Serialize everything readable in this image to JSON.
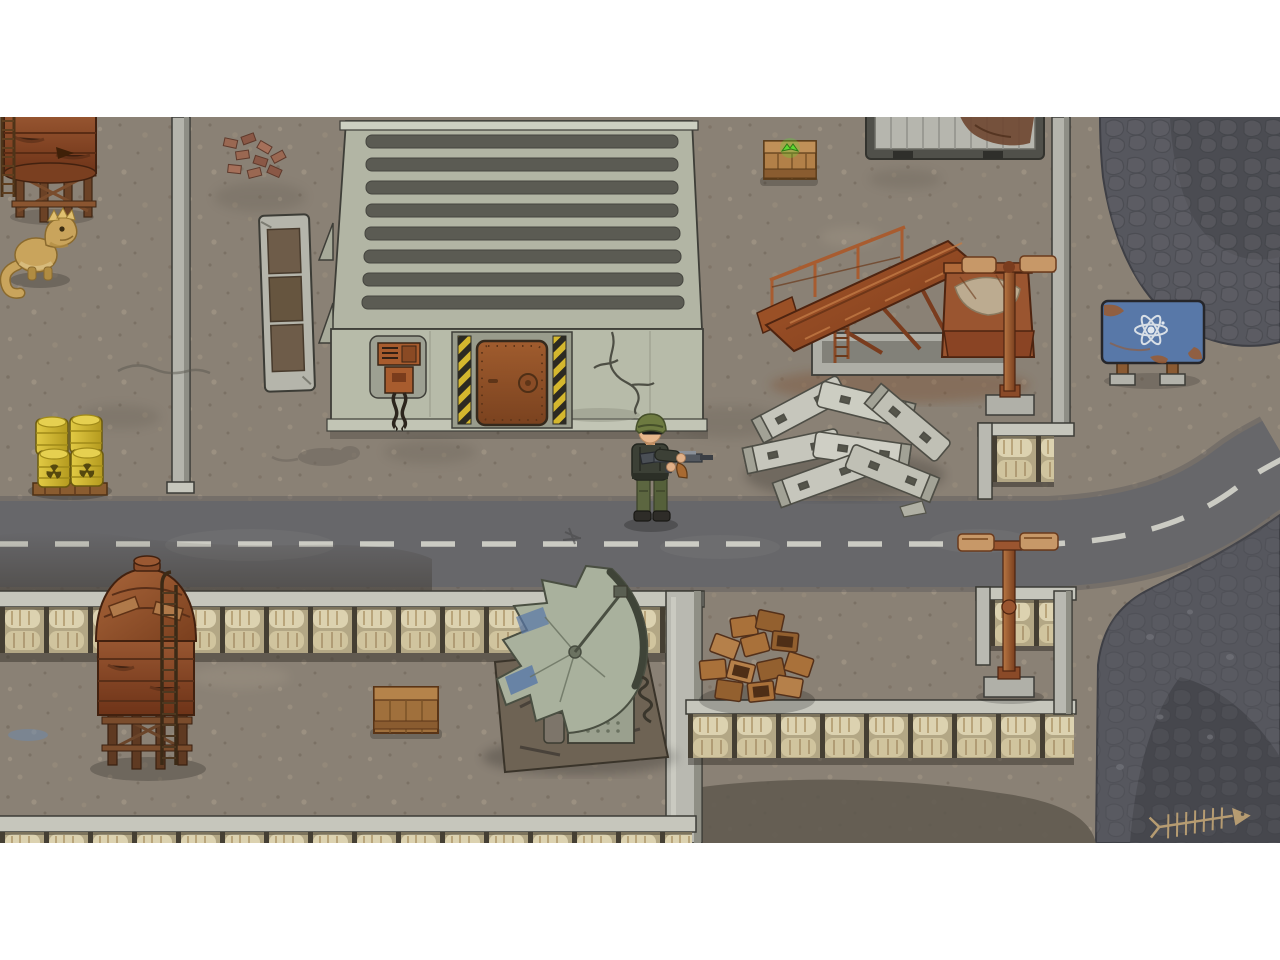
{
  "meta": {
    "app": "top-down post-apocalyptic survival game scene",
    "hud_text": "none visible",
    "letterbox": "#ffffff"
  },
  "palette": {
    "dirt": "#8a8175",
    "road": "#67676a",
    "road_line": "#d6d6cd",
    "gravel": "#56575e",
    "gravel_dark": "#4b4c52",
    "concrete_wall": "#b7bba9",
    "concrete_cap": "#c6c6bc",
    "roof": "#b2b5a4",
    "roof_rib": "#5b5b53",
    "sandbag": "#dcd2b0",
    "rust": "#9a5530",
    "rust_dark": "#6b3a20",
    "wood": "#a9773f",
    "barrel_yellow": "#d8c23a",
    "sign_blue": "#5878a8",
    "loot_green": "#5fd832",
    "hazard_yellow": "#d4b72e"
  },
  "entities": {
    "soldier": {
      "label": "Soldier with rifle"
    },
    "lizard": {
      "label": "Mutant lizard"
    },
    "water_tower": {
      "label": "Rusty water tower"
    },
    "barrels": {
      "label": "Radioactive yellow barrels on pallet"
    },
    "warehouse": {
      "label": "Concrete warehouse with corrugated roof"
    },
    "door": {
      "label": "Rusty armored door with hazard stripes"
    },
    "power_box": {
      "label": "Rusty wall power box with cables"
    },
    "rack": {
      "label": "Concrete rack frame"
    },
    "loot_crate": {
      "label": "Wooden supply crate with green loot marker"
    },
    "truck": {
      "label": "Wrecked flatbed truck"
    },
    "conveyor": {
      "label": "Rusty conveyor crusher machine"
    },
    "lamp_north": {
      "label": "Rusty double street lamp"
    },
    "lamp_south": {
      "label": "Rusty double street lamp"
    },
    "sign": {
      "label": "Blue atom radiation sign"
    },
    "blocks": {
      "label": "Pile of concrete blocks"
    },
    "road": {
      "label": "Cracked asphalt road with dashed line"
    },
    "trench": {
      "label": "Sandbag trench walls"
    },
    "silo": {
      "label": "Rusty domed silo on legs"
    },
    "crate": {
      "label": "Wooden crate"
    },
    "satellite": {
      "label": "Crashed satellite dish wreck"
    },
    "crate_pile": {
      "label": "Mound of wooden crates"
    },
    "fish": {
      "label": "Fish skeleton"
    },
    "rat": {
      "label": "Dead rat silhouette"
    }
  }
}
